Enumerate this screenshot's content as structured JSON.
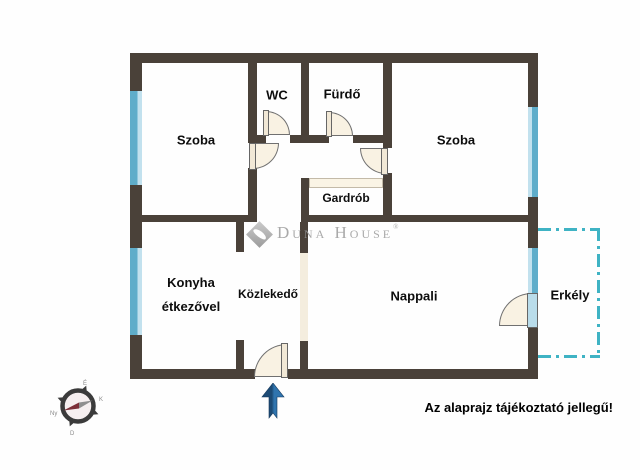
{
  "rooms": {
    "szoba_left": {
      "label": "Szoba"
    },
    "wc": {
      "label": "WC"
    },
    "furdo": {
      "label": "Fürdő"
    },
    "szoba_right": {
      "label": "Szoba"
    },
    "gardrob": {
      "label": "Gardrób"
    },
    "konyha": {
      "label_line1": "Konyha",
      "label_line2": "étkezővel"
    },
    "kozlekedo": {
      "label": "Közlekedő"
    },
    "nappali": {
      "label": "Nappali"
    },
    "erkely": {
      "label": "Erkély"
    }
  },
  "watermark": {
    "brand": "Duna House",
    "registered": "®"
  },
  "disclaimer": "Az alaprajz tájékoztató jellegű!",
  "compass": {
    "north": "É",
    "east": "K",
    "south": "D",
    "west": "Ny"
  },
  "colors": {
    "wall": "#4a4139",
    "window": "#5fadca",
    "balcony_dash": "#3fb3c4",
    "door_fill": "#f9f2e3",
    "arrow_dark": "#1c4a74",
    "arrow_light": "#2f74ae",
    "needle_red": "#7c2f38",
    "needle_gray": "#8f8f8f"
  }
}
